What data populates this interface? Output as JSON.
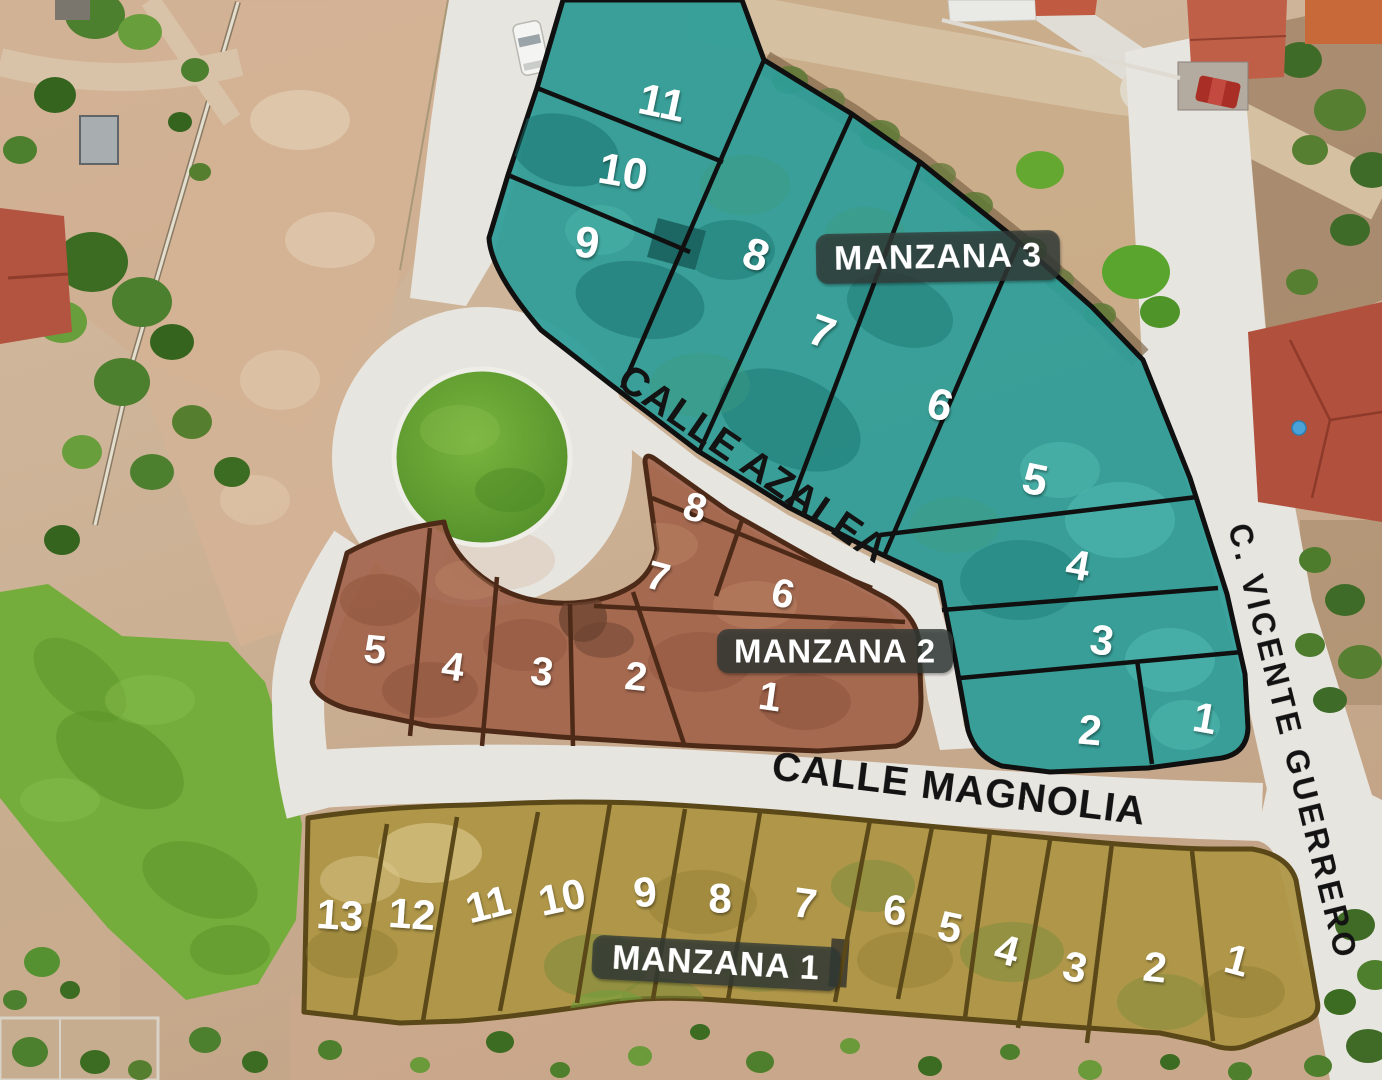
{
  "streets": {
    "azalea": "CALLE AZALEA",
    "magnolia": "CALLE MAGNOLIA",
    "vicente_guerrero": "C. VICENTE GUERRERO"
  },
  "manzanas": {
    "m3": {
      "label": "MANZANA 3",
      "color": "#2d9d98",
      "outline": "#101010",
      "lots": [
        "11",
        "10",
        "9",
        "8",
        "7",
        "6",
        "5",
        "4",
        "3",
        "2",
        "1"
      ]
    },
    "m2": {
      "label": "MANZANA 2",
      "color": "#a2644b",
      "outline": "#4d2a18",
      "lots": [
        "8",
        "7",
        "6",
        "5",
        "4",
        "3",
        "2",
        "1"
      ]
    },
    "m1": {
      "label": "MANZANA 1",
      "color": "#ad9543",
      "outline": "#5a4818",
      "lots": [
        "13",
        "12",
        "11",
        "10",
        "9",
        "8",
        "7",
        "6",
        "5",
        "4",
        "3",
        "2",
        "1"
      ]
    }
  },
  "label_style": {
    "bg": "#2f3a35",
    "text_color": "#ffffff"
  }
}
